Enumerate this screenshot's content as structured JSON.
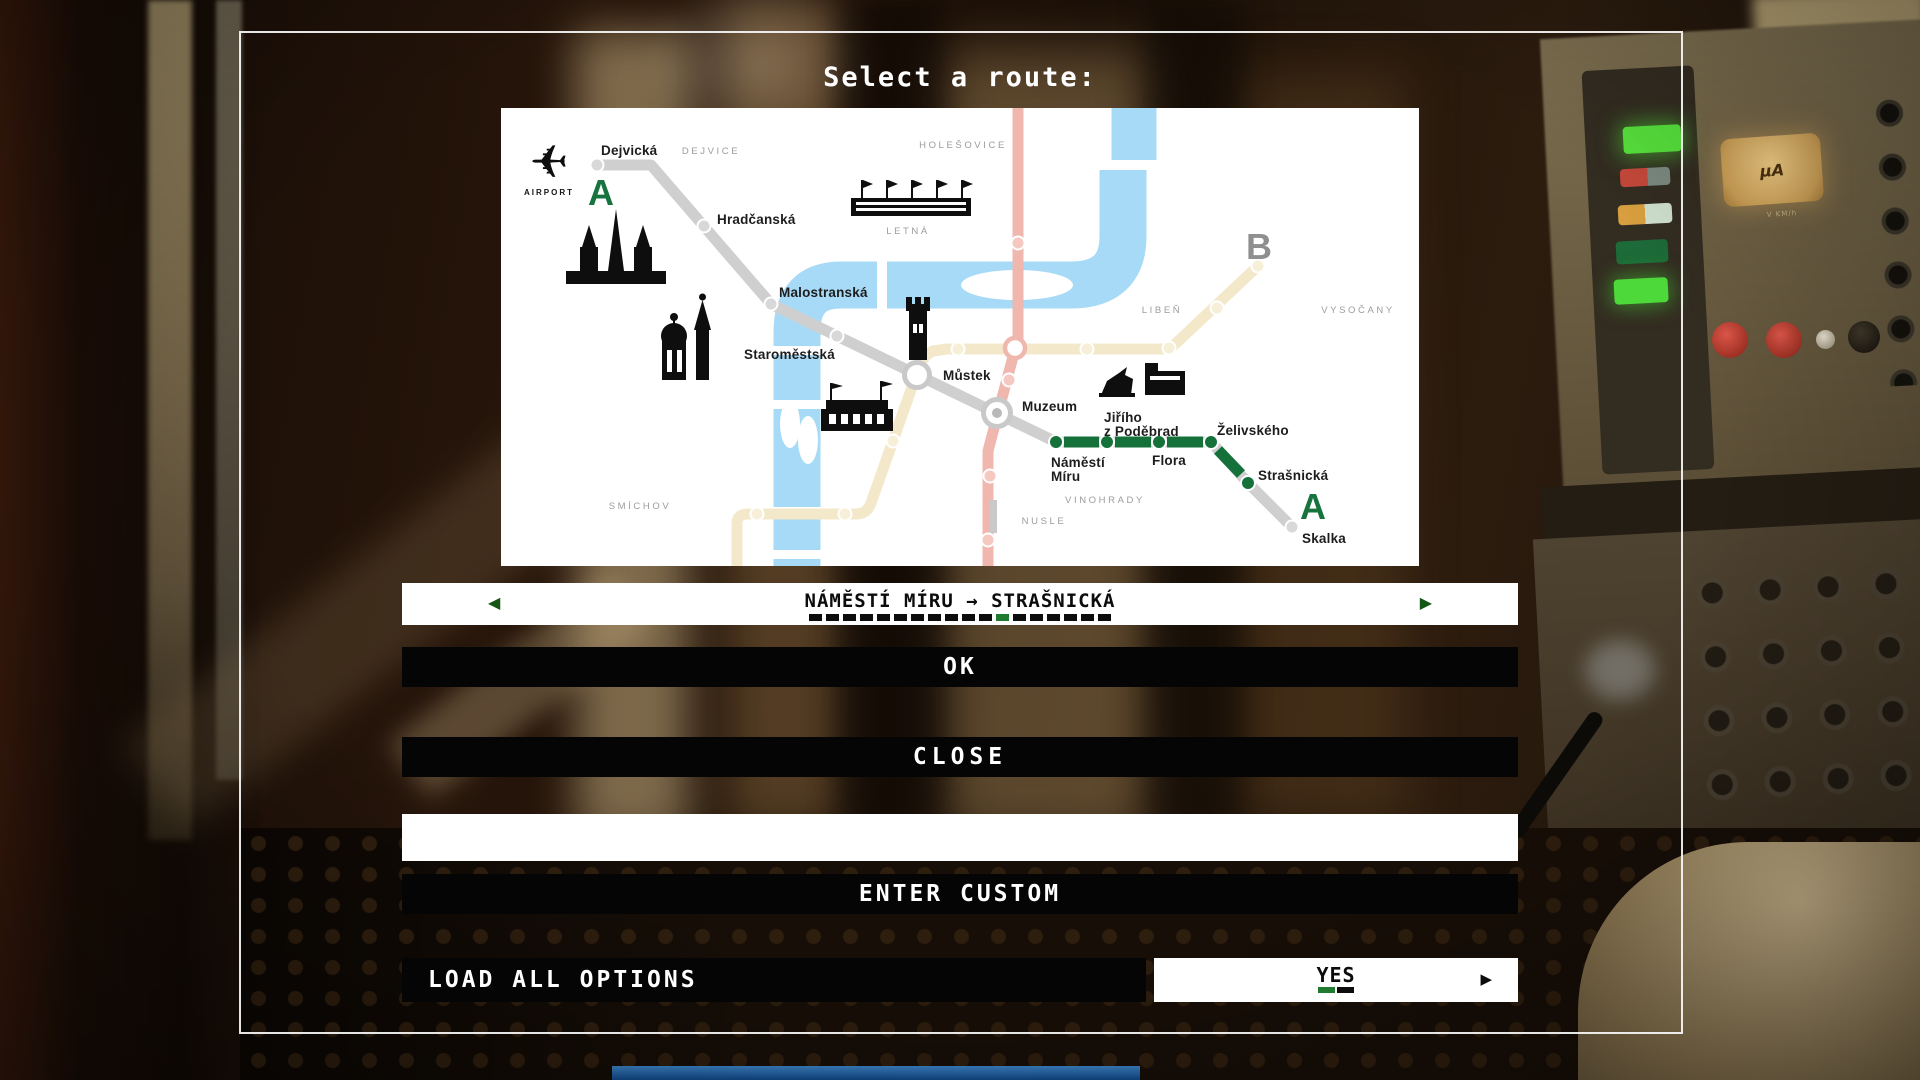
{
  "title": "Select a route:",
  "route_selector": {
    "value": "NÁMĚSTÍ MÍRU → STRAŠNICKÁ",
    "prev_arrow": "◀",
    "next_arrow": "▶",
    "dashes_total": 18,
    "active_dash_index": 11
  },
  "buttons": {
    "ok": "OK",
    "close": "CLOSE",
    "enter_custom": "ENTER CUSTOM",
    "load_all_options": "LOAD ALL OPTIONS"
  },
  "custom_input": {
    "value": "",
    "placeholder": ""
  },
  "load_toggle": {
    "value": "YES",
    "arrow": "▶"
  },
  "scene": {
    "gauge_label": "µA",
    "gauge_sublabel": "V KM/h"
  },
  "colors": {
    "accent_green": "#17743F",
    "dash_green": "#1E7B2F",
    "line_gray": "#CFCFCF",
    "line_cream": "#F3E8CA",
    "line_red": "#F0B7AE",
    "river": "#A7DAF6",
    "district_gray": "#9C9C9C",
    "letter_b_gray": "#8F8F8F"
  },
  "map": {
    "letters": [
      {
        "text": "A",
        "x": 100,
        "y": 97,
        "color": "#17743F"
      },
      {
        "text": "A",
        "x": 812,
        "y": 411,
        "color": "#17743F"
      },
      {
        "text": "B",
        "x": 758,
        "y": 151,
        "color": "#8F8F8F"
      }
    ],
    "airport": {
      "label": "AIRPORT",
      "x": 48,
      "y": 87
    },
    "districts": [
      {
        "label": "DEJVICE",
        "x": 210,
        "y": 46
      },
      {
        "label": "HOLEŠOVICE",
        "x": 462,
        "y": 40
      },
      {
        "label": "LETNÁ",
        "x": 407,
        "y": 126
      },
      {
        "label": "LIBEŇ",
        "x": 661,
        "y": 205
      },
      {
        "label": "VYSOČANY",
        "x": 857,
        "y": 205
      },
      {
        "label": "SMÍCHOV",
        "x": 139,
        "y": 401
      },
      {
        "label": "VINOHRADY",
        "x": 604,
        "y": 395
      },
      {
        "label": "NUSLE",
        "x": 543,
        "y": 416
      }
    ],
    "river": {
      "strokes": [
        {
          "d": "M 633 -6 L 633 52",
          "w": 45
        },
        {
          "d": "M 622 62 L 622 128 Q 622 177 570 177 L 340 177 Q 296 177 296 224 L 296 458",
          "w": 47
        }
      ],
      "islands": [
        {
          "cx": 516,
          "cy": 177,
          "rx": 56,
          "ry": 15
        },
        {
          "cx": 289,
          "cy": 316,
          "rx": 10,
          "ry": 24
        },
        {
          "cx": 307,
          "cy": 332,
          "rx": 10,
          "ry": 24
        }
      ],
      "gaps": [
        {
          "x": 376,
          "y": 151,
          "w": 10,
          "h": 52
        },
        {
          "x": 268,
          "y": 238,
          "w": 56,
          "h": 9
        },
        {
          "x": 268,
          "y": 292,
          "w": 56,
          "h": 9
        },
        {
          "x": 268,
          "y": 399,
          "w": 56,
          "h": 9
        },
        {
          "x": 268,
          "y": 442,
          "w": 56,
          "h": 9
        }
      ]
    },
    "lines": {
      "b": {
        "color": "#F3E8CA",
        "width": 11,
        "d": "M 236 458 L 236 415 Q 236 406 247 406 L 355 406 Q 366 406 370 395 L 417 262 Q 421 248 432 243 L 446 241 L 662 241 L 671 239 L 757 158"
      },
      "c": {
        "color": "#F0B7AE",
        "width": 11,
        "d": "M 517 0 L 517 230 L 497 305 L 487 343 L 487 458"
      },
      "a": {
        "color": "#CFCFCF",
        "width": 11,
        "d": "M 96 57 L 150 57 L 270 196 L 555 334 L 710 334 L 747 375 L 791 419"
      },
      "green": {
        "color": "#15713A",
        "width": 11,
        "segments": [
          "M 563 334 L 598 334",
          "M 614 334 L 650 334",
          "M 666 334 L 702 334",
          "M 717 342 L 740 366"
        ]
      }
    },
    "extras": [
      {
        "x": 489,
        "y": 392,
        "w": 7,
        "h": 33,
        "fill": "#C9C9C9"
      }
    ],
    "stations": [
      {
        "x": 96,
        "y": 57,
        "kind": "gray",
        "label": "Dejvická",
        "lx": 100,
        "ly": 47
      },
      {
        "x": 203,
        "y": 118,
        "kind": "gray",
        "label": "Hradčanská",
        "lx": 216,
        "ly": 116
      },
      {
        "x": 270,
        "y": 196,
        "kind": "gray",
        "label": "Malostranská",
        "lx": 278,
        "ly": 189
      },
      {
        "x": 336,
        "y": 228,
        "kind": "gray",
        "label": "Staroměstská",
        "lx": 243,
        "ly": 251
      },
      {
        "x": 416,
        "y": 267,
        "kind": "interchange-ab",
        "label": "Můstek",
        "lx": 442,
        "ly": 272
      },
      {
        "x": 496,
        "y": 305,
        "kind": "interchange-ac",
        "label": "Muzeum",
        "lx": 521,
        "ly": 303
      },
      {
        "x": 514,
        "y": 240,
        "kind": "interchange-bc",
        "label": ""
      },
      {
        "x": 555,
        "y": 334,
        "kind": "green",
        "label": "Náměstí\nMíru",
        "lx": 550,
        "ly": 359
      },
      {
        "x": 606,
        "y": 334,
        "kind": "green",
        "label": "Jiřího\nz Poděbrad",
        "lx": 603,
        "ly": 314
      },
      {
        "x": 658,
        "y": 334,
        "kind": "green",
        "label": "Flora",
        "lx": 651,
        "ly": 357
      },
      {
        "x": 710,
        "y": 334,
        "kind": "green",
        "label": "Želivského",
        "lx": 716,
        "ly": 327
      },
      {
        "x": 747,
        "y": 375,
        "kind": "green",
        "label": "Strašnická",
        "lx": 757,
        "ly": 372
      },
      {
        "x": 791,
        "y": 419,
        "kind": "gray",
        "label": "Skalka",
        "lx": 801,
        "ly": 435
      },
      {
        "x": 256,
        "y": 406,
        "kind": "cream"
      },
      {
        "x": 344,
        "y": 406,
        "kind": "cream"
      },
      {
        "x": 392,
        "y": 333,
        "kind": "cream"
      },
      {
        "x": 457,
        "y": 241,
        "kind": "cream"
      },
      {
        "x": 586,
        "y": 241,
        "kind": "cream"
      },
      {
        "x": 668,
        "y": 240,
        "kind": "cream"
      },
      {
        "x": 716,
        "y": 200,
        "kind": "cream"
      },
      {
        "x": 757,
        "y": 158,
        "kind": "cream"
      },
      {
        "x": 517,
        "y": 135,
        "kind": "red"
      },
      {
        "x": 508,
        "y": 272,
        "kind": "red"
      },
      {
        "x": 489,
        "y": 368,
        "kind": "red"
      },
      {
        "x": 487,
        "y": 432,
        "kind": "red"
      }
    ],
    "icons": [
      {
        "name": "airport-icon",
        "x": 48,
        "y": 56
      },
      {
        "name": "castle-icon",
        "x": 115,
        "y": 143
      },
      {
        "name": "church-towers-icon",
        "x": 186,
        "y": 236
      },
      {
        "name": "bridge-tower-icon",
        "x": 417,
        "y": 214
      },
      {
        "name": "theater-icon",
        "x": 356,
        "y": 305
      },
      {
        "name": "stadium-icon",
        "x": 410,
        "y": 98
      },
      {
        "name": "memorial-icon",
        "x": 640,
        "y": 277
      }
    ]
  }
}
